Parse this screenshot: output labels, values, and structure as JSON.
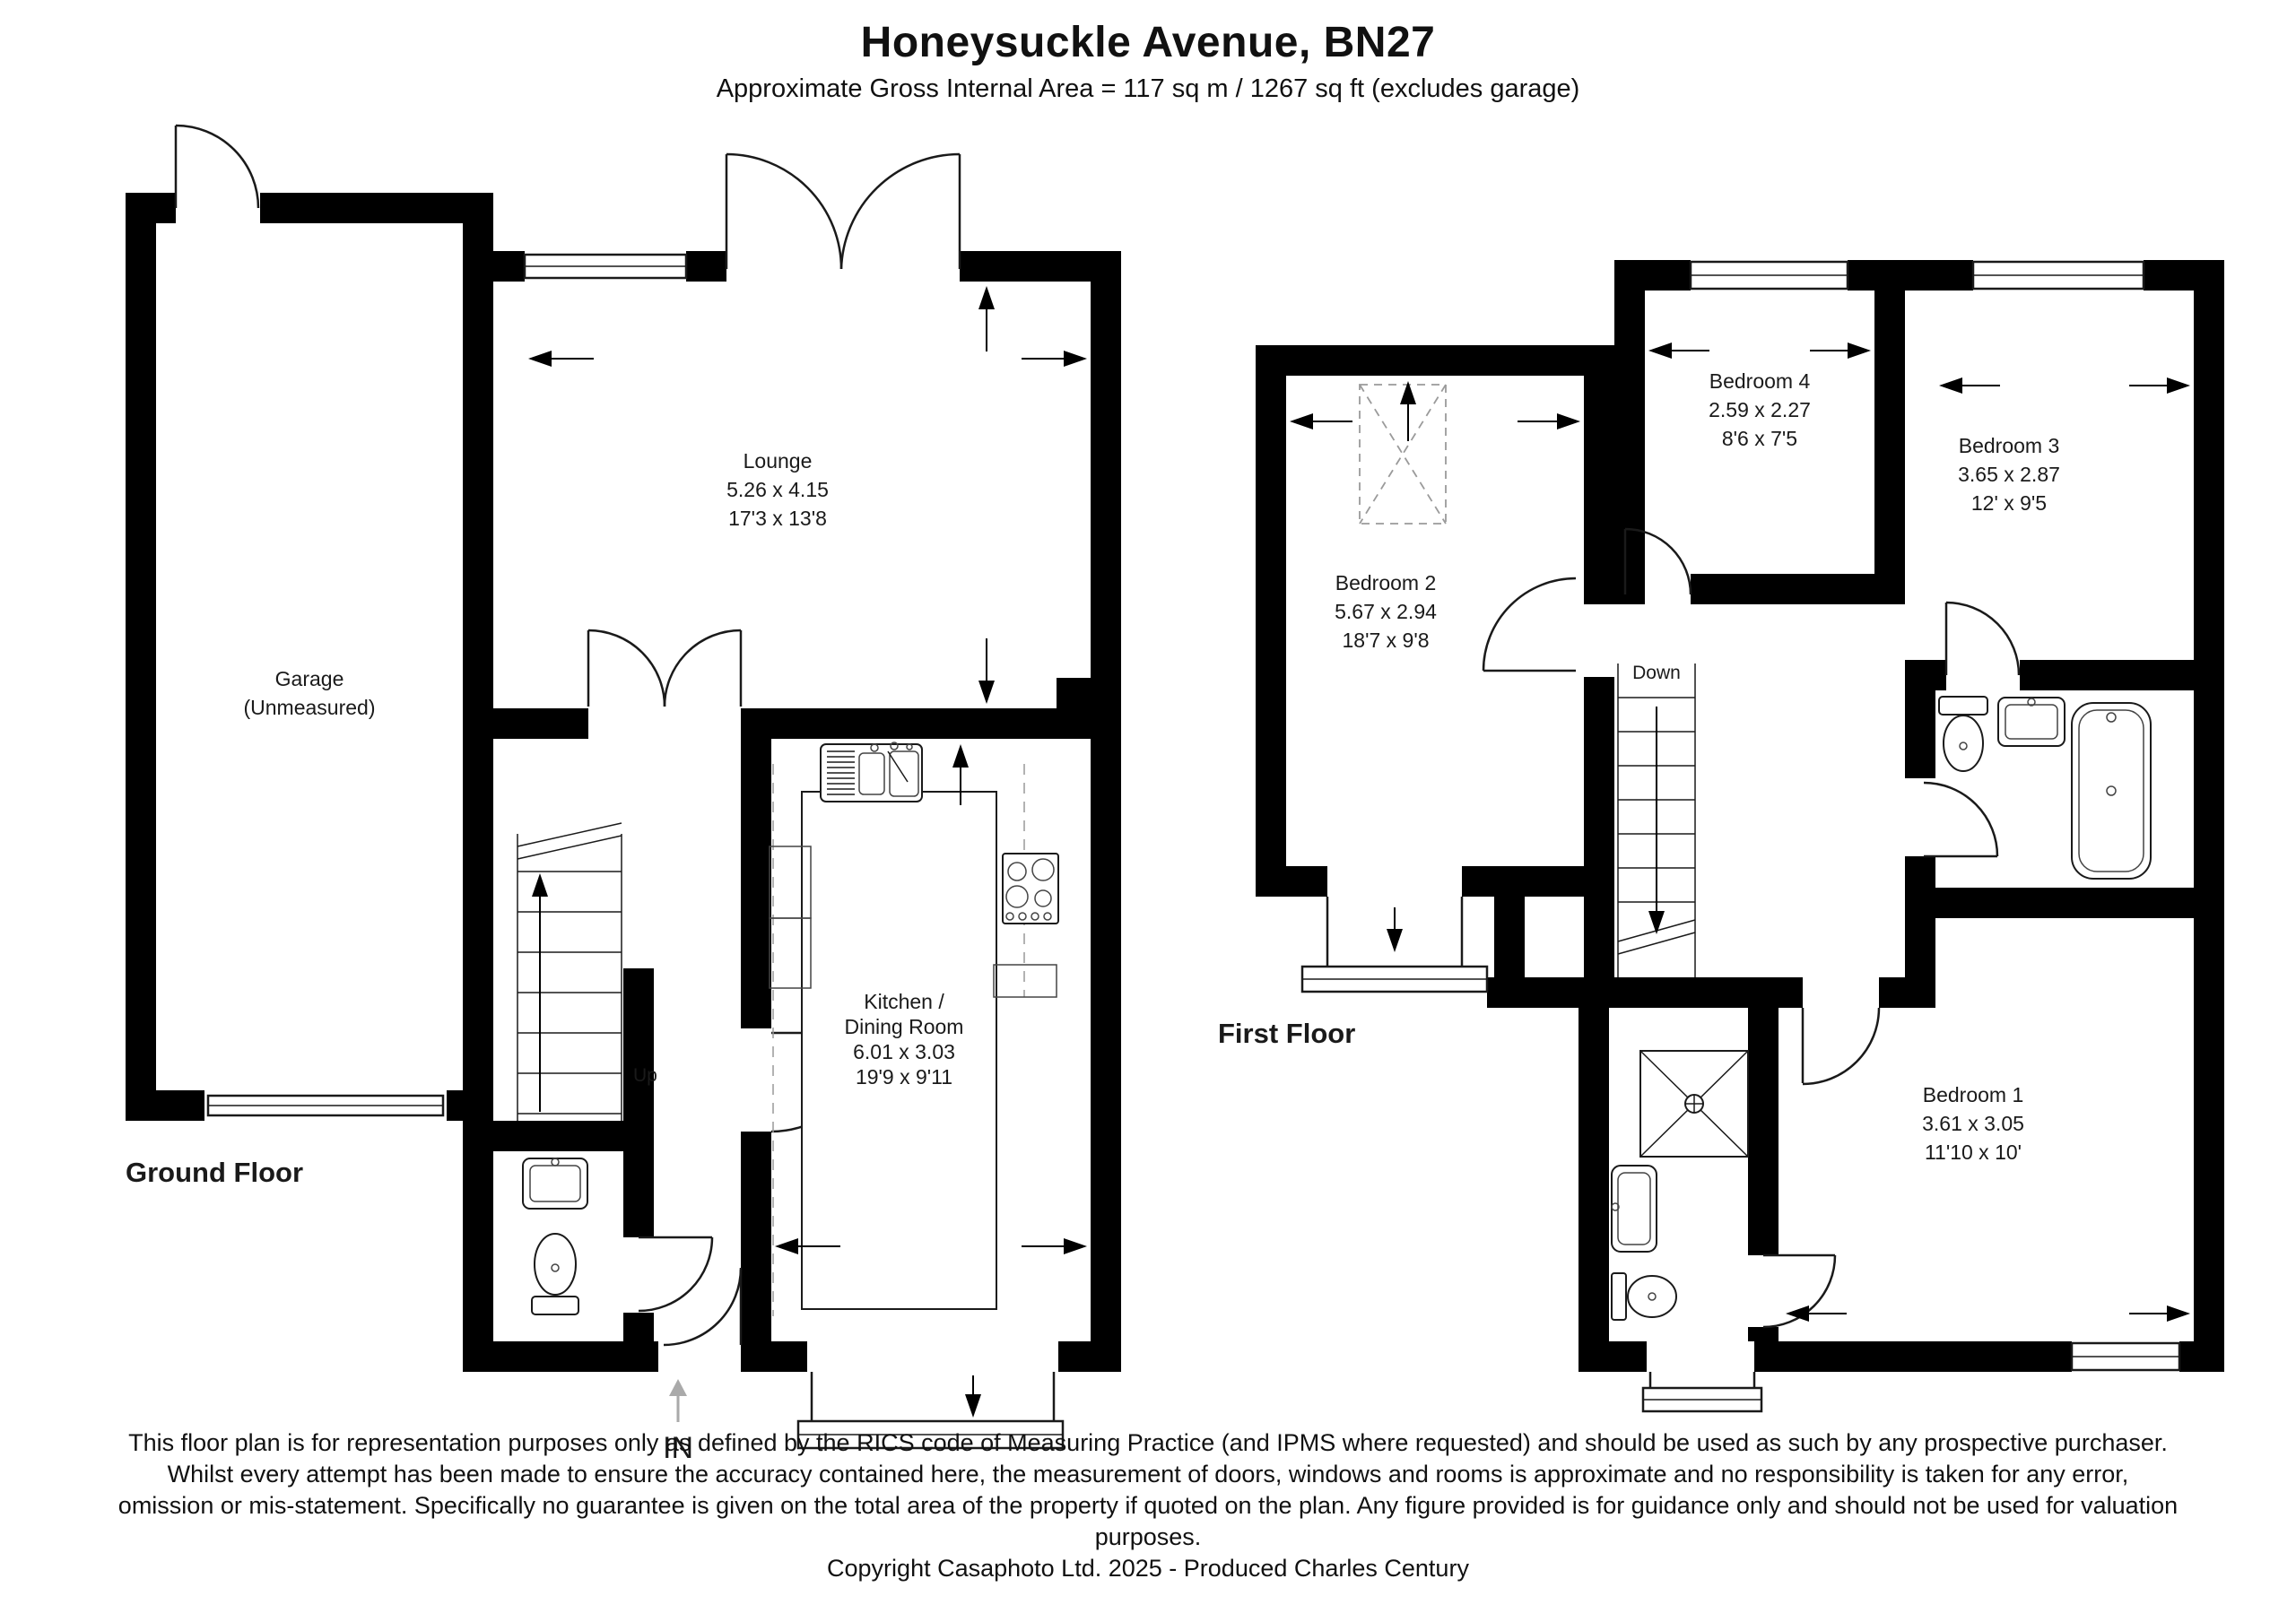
{
  "header": {
    "title": "Honeysuckle Avenue, BN27",
    "subtitle": "Approximate Gross Internal Area = 117 sq m / 1267 sq ft (excludes garage)"
  },
  "ground_floor": {
    "label": "Ground Floor",
    "entrance_label": "IN",
    "stairs_label": "Up",
    "garage": {
      "name": "Garage",
      "note": "(Unmeasured)"
    },
    "lounge": {
      "name": "Lounge",
      "metric": "5.26 x 4.15",
      "imperial": "17'3 x 13'8"
    },
    "kitchen": {
      "name_line1": "Kitchen /",
      "name_line2": "Dining Room",
      "metric": "6.01 x 3.03",
      "imperial": "19'9 x 9'11"
    }
  },
  "first_floor": {
    "label": "First Floor",
    "stairs_label": "Down",
    "bedroom1": {
      "name": "Bedroom 1",
      "metric": "3.61 x 3.05",
      "imperial": "11'10 x 10'"
    },
    "bedroom2": {
      "name": "Bedroom 2",
      "metric": "5.67 x 2.94",
      "imperial": "18'7 x 9'8"
    },
    "bedroom3": {
      "name": "Bedroom 3",
      "metric": "3.65 x 2.87",
      "imperial": "12' x 9'5"
    },
    "bedroom4": {
      "name": "Bedroom 4",
      "metric": "2.59 x 2.27",
      "imperial": "8'6 x 7'5"
    }
  },
  "footer": {
    "disclaimer": "This floor plan is for representation purposes only as defined by the RICS code of Measuring Practice (and IPMS where requested) and should be used as such by any prospective purchaser. Whilst every attempt has been made to ensure the accuracy contained here, the measurement of doors, windows and rooms is approximate and no responsibility is taken for any error, omission or mis-statement. Specifically no guarantee is given on the total area of the property if quoted on the plan. Any figure provided is for guidance only and should not be used for valuation purposes.",
    "copyright": "Copyright Casaphoto Ltd. 2025 - Produced Charles Century"
  },
  "colors": {
    "wall": "#000000",
    "background": "#ffffff",
    "thin_line": "#1a1a1a",
    "muted": "#aaaaaa"
  }
}
